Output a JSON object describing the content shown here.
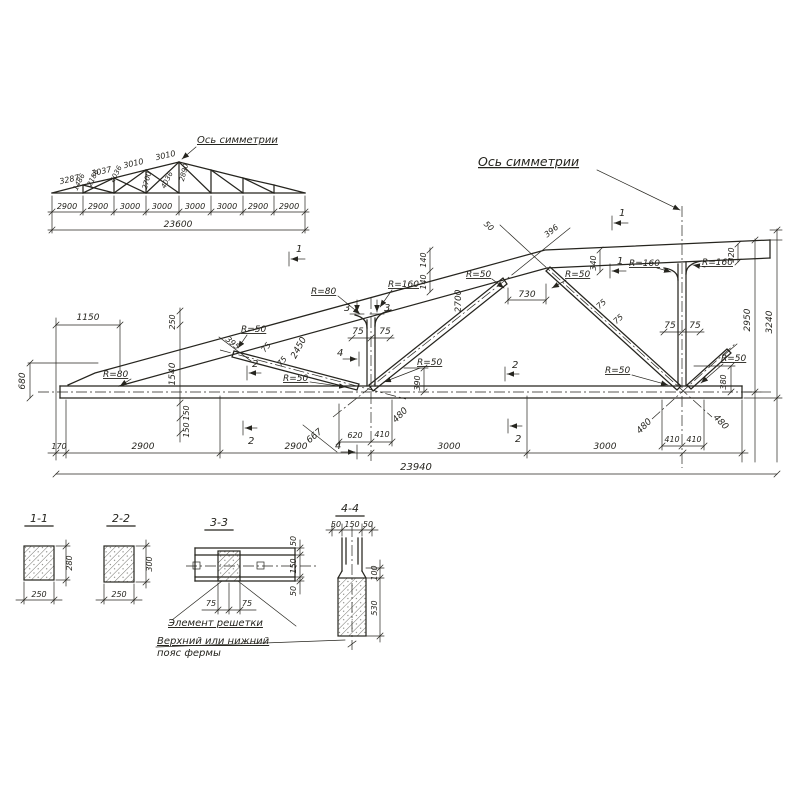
{
  "drawing": {
    "background": "#ffffff",
    "ink": "#26251f"
  },
  "overview": {
    "axis_label": "Ось симметрии",
    "top_chord_segments": [
      "3287",
      "3037",
      "3010",
      "3010"
    ],
    "web_members": [
      "1486",
      "2186",
      "4036",
      "2700",
      "4036",
      "2890"
    ],
    "panel_dims": [
      "2900",
      "2900",
      "3000",
      "3000",
      "3000",
      "3000",
      "2900",
      "2900"
    ],
    "total_span": "23600"
  },
  "main": {
    "axis_label": "Ось симметрии",
    "marks": {
      "m1": "1",
      "m2": "2",
      "m3": "3",
      "m4": "4"
    },
    "dims": {
      "w1150": "1150",
      "h680": "680",
      "w170": "170",
      "w2900": "2900",
      "w3000": "3000",
      "total": "23940",
      "w620": "620",
      "w410": "410",
      "d480": "480",
      "d667": "667",
      "h390": "390",
      "h380": "380",
      "h250": "250",
      "h1540": "1540",
      "h150": "150",
      "d395": "395",
      "d2450": "2450",
      "h2700": "2700",
      "w730": "730",
      "g50": "50",
      "d396": "396",
      "h140": "140",
      "h340": "340",
      "h320": "320",
      "h2950": "2950",
      "h3240": "3240",
      "g75": "75",
      "r50": "R=50",
      "r80": "R=80",
      "r160": "R=160"
    }
  },
  "sections": {
    "s11": {
      "title": "1-1",
      "width": "250",
      "height": "280"
    },
    "s22": {
      "title": "2-2",
      "width": "250",
      "height": "300"
    },
    "s33": {
      "title": "3-3",
      "g50": "50",
      "g150": "150",
      "g75": "75",
      "note1": "Элемент решетки",
      "note2": "Верхний или нижний",
      "note3": "пояс фермы"
    },
    "s44": {
      "title": "4-4",
      "g50": "50",
      "g150": "150",
      "h100": "100",
      "h530": "530"
    }
  }
}
